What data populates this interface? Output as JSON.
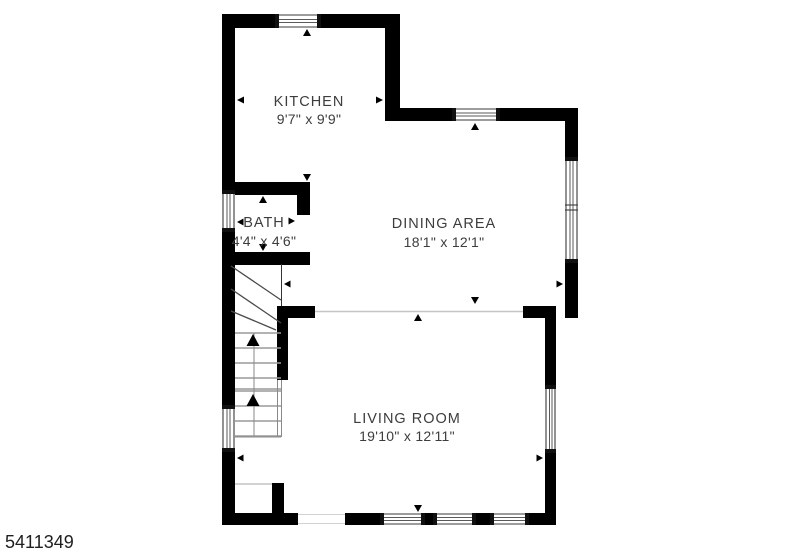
{
  "floorplan": {
    "rooms": {
      "kitchen": {
        "name": "KITCHEN",
        "dims": "9'7\" x 9'9\""
      },
      "dining": {
        "name": "DINING AREA",
        "dims": "18'1\" x 12'1\""
      },
      "bath": {
        "name": "BATH",
        "dims": "4'4\" x 4'6\""
      },
      "living": {
        "name": "LIVING ROOM",
        "dims": "19'10\" x 12'11\""
      }
    },
    "stairs": {
      "direction": "up"
    },
    "listing_id": "5411349",
    "colors": {
      "wall": "#000000",
      "room_label": "#3d3d3d",
      "listing_id_text": "#1f1f1f",
      "background": "#ffffff"
    }
  }
}
